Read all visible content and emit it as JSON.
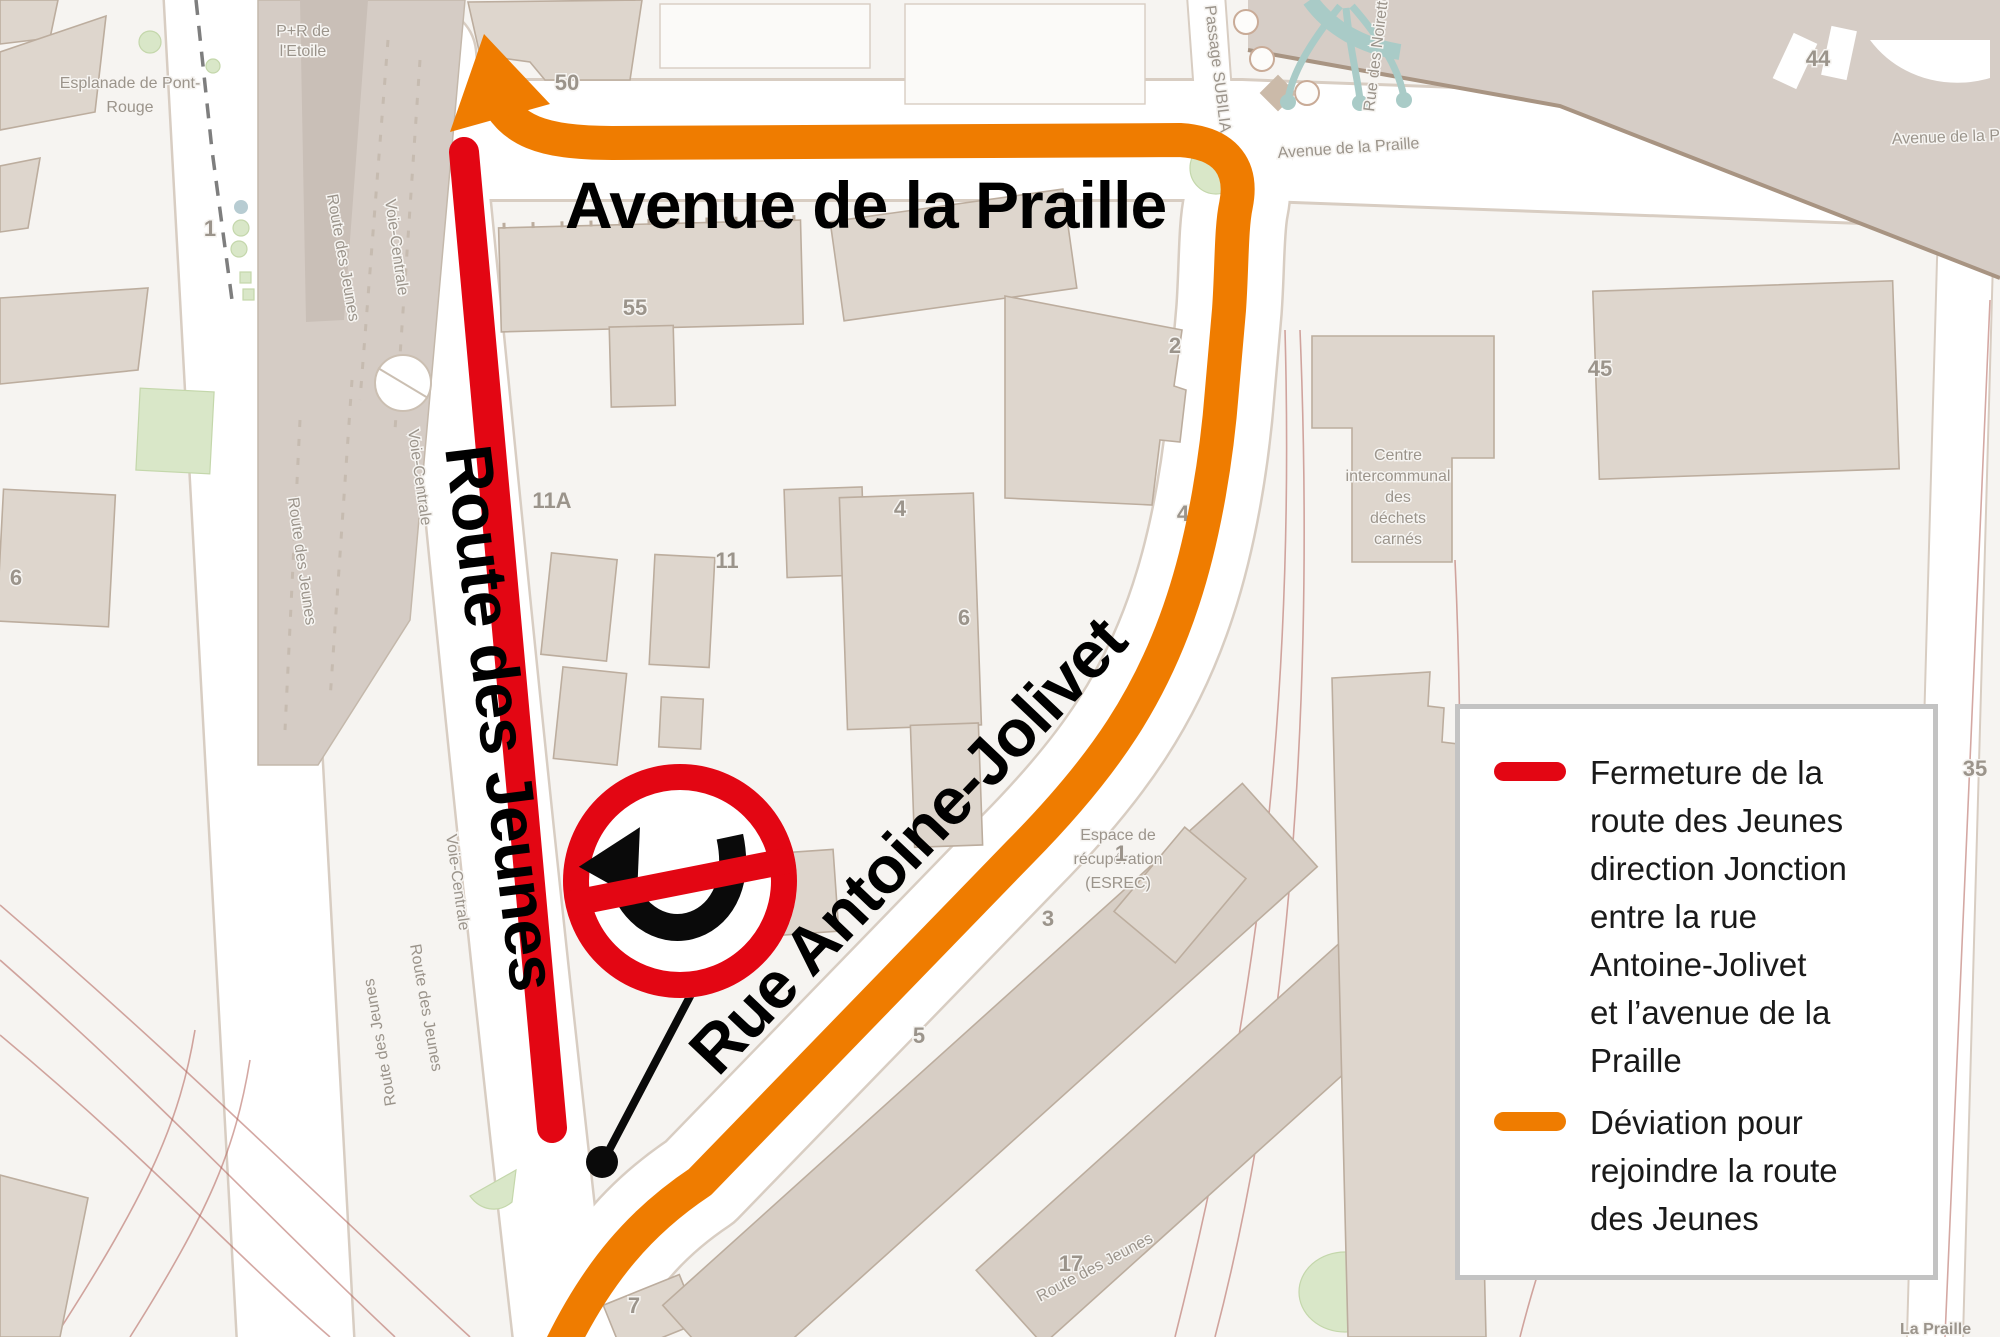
{
  "colors": {
    "closure_red": "#e30613",
    "deviation_orange": "#ef7c00",
    "map_bg": "#f6f4f1",
    "road_fill": "#ffffff",
    "road_edge": "#d8cdc2",
    "building_fill": "#ded6cd",
    "building_edge": "#bcad9e",
    "building_dark": "#d7cec5",
    "rail_zone": "#d5ccc5",
    "rail_track": "#b06058",
    "green_area": "#d9e7c8",
    "green_edge": "#c4d7ab",
    "water_teal": "#a9cbc7",
    "label_gray": "#9b948b",
    "big_label": "#000000",
    "sign_black": "#0a0a0a",
    "legend_border": "#c3c3c3",
    "legend_text": "#1a1a1a"
  },
  "major_labels": {
    "avenue_de_la_praille": "Avenue de la Praille",
    "route_des_jeunes": "Route des Jeunes",
    "rue_antoine_jolivet": "Rue Antoine-Jolivet"
  },
  "streets": {
    "esplanade_line1": "Esplanade de Pont-",
    "esplanade_line2": "Rouge",
    "pr_etoile_line1": "P+R de",
    "pr_etoile_line2": "l'Etoile",
    "route_des_jeunes": "Route des Jeunes",
    "voie_centrale": "Voie-Centrale",
    "passage_subilia": "Passage SUBILIA",
    "rue_des_noirettes": "Rue des Noirettes",
    "avenue_praille_small": "Avenue de la Praille",
    "avenue_praille_short": "Avenue de la Pr",
    "la_praille": "La Praille",
    "centre_lines": [
      "Centre",
      "intercommunal",
      "des",
      "déchets",
      "carnés"
    ],
    "esrec_lines": [
      "Espace de",
      "récupération",
      "(ESREC)"
    ]
  },
  "numbers": {
    "n50": "50",
    "n55": "55",
    "n11a": "11A",
    "n11": "11",
    "n4": "4",
    "n6": "6",
    "n2": "2",
    "n1": "1",
    "n3": "3",
    "n5": "5",
    "n7": "7",
    "n17": "17",
    "n44": "44",
    "n45": "45",
    "n45a": "45A",
    "n35": "35",
    "n1b": "1",
    "n6b": "6"
  },
  "legend": {
    "items": [
      {
        "symbol": "closure-red-line",
        "lines": [
          "Fermeture de la",
          "route des Jeunes",
          "direction Jonction",
          "entre la rue",
          "Antoine-Jolivet",
          "et l’avenue de la",
          "Praille"
        ]
      },
      {
        "symbol": "deviation-orange-line",
        "lines": [
          "Déviation pour",
          "rejoindre la route",
          "des Jeunes"
        ]
      }
    ]
  }
}
